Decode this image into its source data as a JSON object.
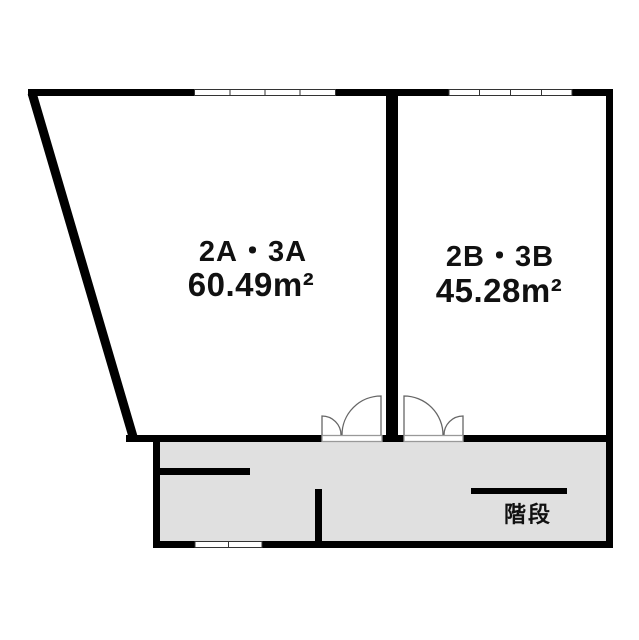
{
  "title": "floor-plan",
  "rooms": [
    {
      "name": "2A・3A",
      "area": "60.49m²"
    },
    {
      "name": "2B・3B",
      "area": "45.28m²"
    }
  ],
  "corridor": {
    "stairs_label": "階段"
  },
  "colors": {
    "wall": "#000000",
    "corridor_fill": "#e0e0e0",
    "window_stroke": "#333333",
    "door_stroke": "#666666",
    "threshold_stroke": "#999999",
    "text": "#111111"
  }
}
